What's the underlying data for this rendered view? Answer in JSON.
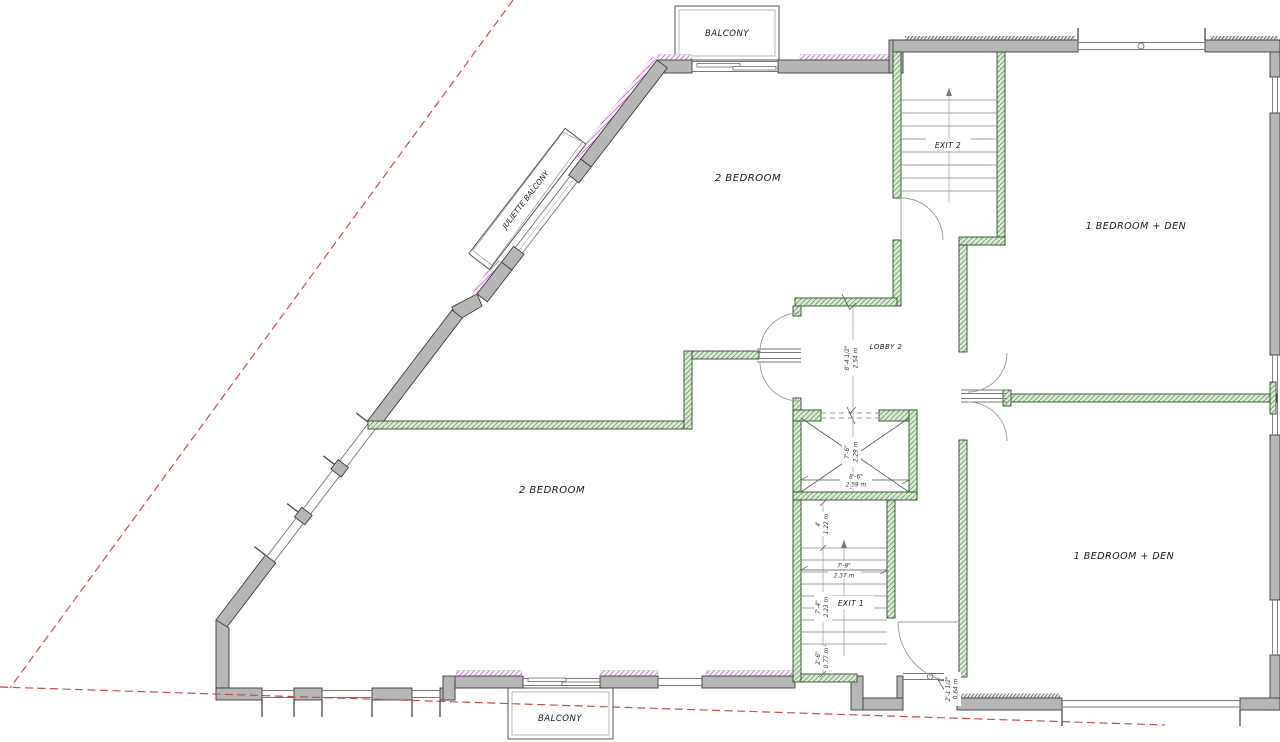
{
  "labels": {
    "balcony_top": "BALCONY",
    "balcony_bottom": "BALCONY",
    "juliette_balcony": "JULIETTE BALCONY",
    "bedroom_top": "2 BEDROOM",
    "bedroom_bottom": "2 BEDROOM",
    "bed_den_top": "1 BEDROOM + DEN",
    "bed_den_bottom": "1 BEDROOM + DEN",
    "lobby": "LOBBY 2",
    "exit2": "EXIT 2",
    "exit1": "EXIT 1"
  },
  "dimensions": {
    "lobby_width_ft": "8'-4 1/2\"",
    "lobby_width_m": "2.54 m",
    "elevator_width_ft": "8'-6\"",
    "elevator_width_m": "2.59 m",
    "elevator_depth_ft": "7'-6\"",
    "elevator_depth_m": "2.29 m",
    "stair1_landing_ft": "4'",
    "stair1_landing_m": "1.22 m",
    "stair1_width_ft": "7'-9\"",
    "stair1_width_m": "2.37 m",
    "stair1_run_ft": "7'-4\"",
    "stair1_run_m": "2.23 m",
    "stair1_bottom_ft": "2'-6\"",
    "stair1_bottom_m": "0.77 m",
    "wall_offset_ft": "2'-1 1/2\"",
    "wall_offset_m": "0.64 m"
  },
  "colors": {
    "wall_fill": "#b6b6b6",
    "wall_outline": "#3c3c3c",
    "partition_green": "#7fa878",
    "exterior_hatch_pink": "#c878c8",
    "property_line_red": "#c0504d"
  }
}
